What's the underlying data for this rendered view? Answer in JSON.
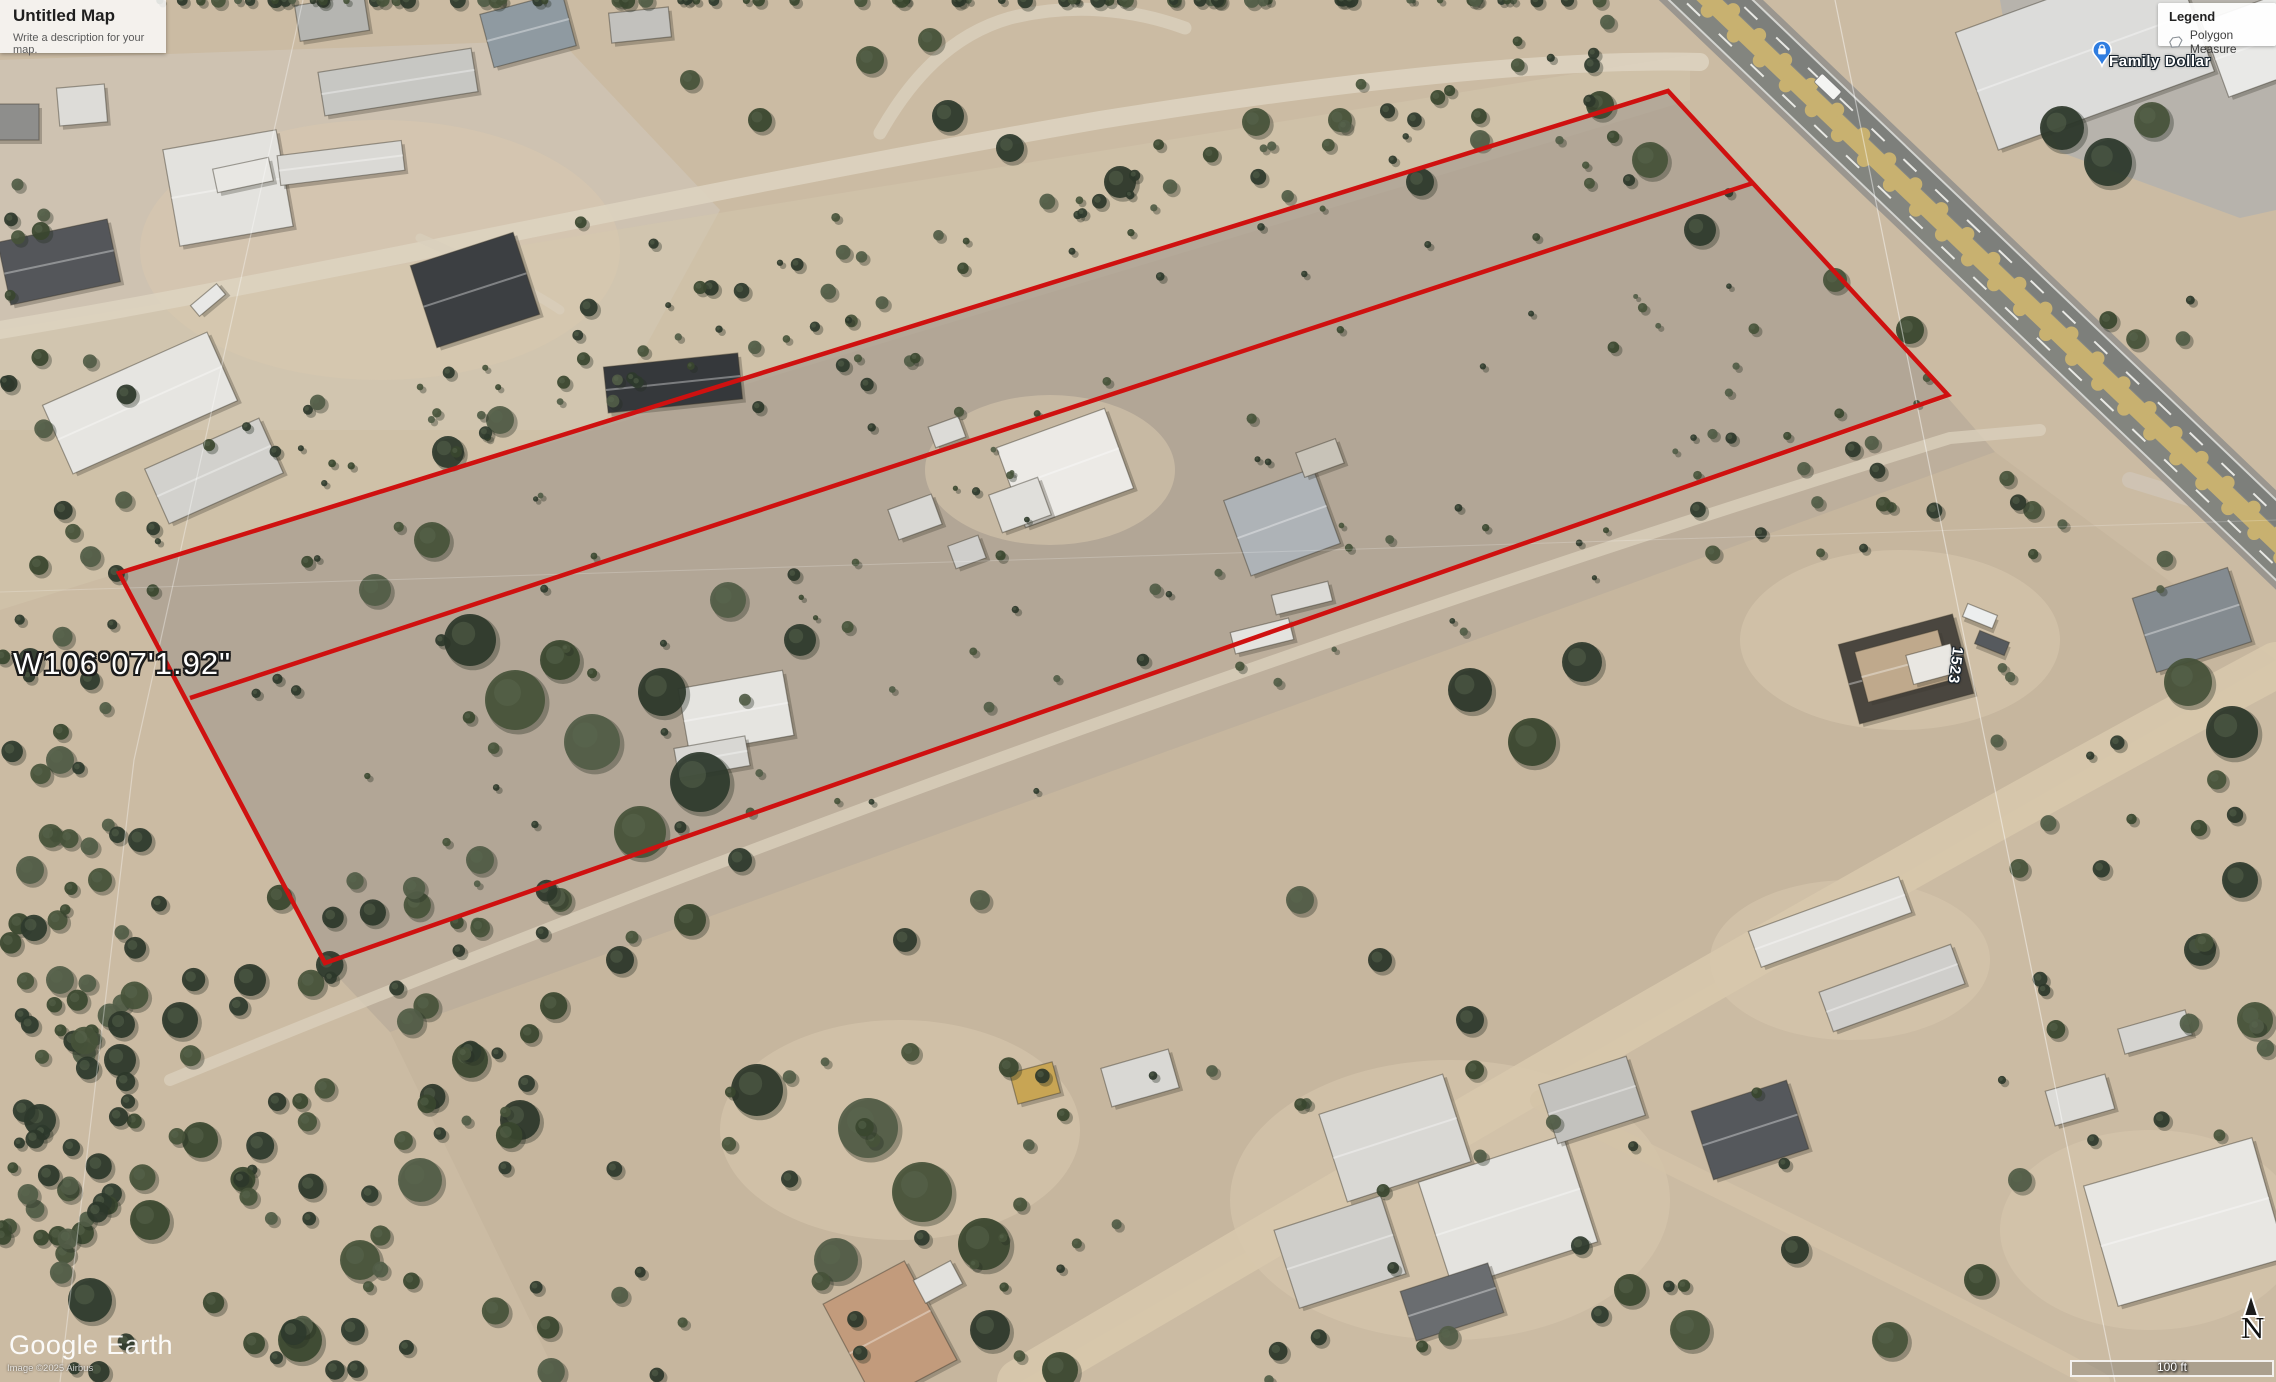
{
  "map_panel": {
    "title": "Untitled Map",
    "description_placeholder": "Write a description for your map."
  },
  "legend_panel": {
    "title": "Legend",
    "items": [
      {
        "icon": "polygon-icon",
        "label": "Polygon Measure"
      }
    ]
  },
  "map_labels": {
    "place": {
      "name": "Family Dollar",
      "icon": "place-pin-icon",
      "pin_color": "#2f7de0"
    },
    "coordinate": "W106°07'1.92\"",
    "house_number": "1523"
  },
  "watermark": {
    "logo": "Google Earth",
    "attribution": "Image ©2025 Airbus"
  },
  "navigation": {
    "north_label": "N",
    "scale_label": "100 ft"
  },
  "measure_overlay": {
    "color": "#cf1110",
    "stroke_width": 4.5,
    "outline_points": [
      [
        119,
        573
      ],
      [
        1668,
        91
      ],
      [
        1948,
        395
      ],
      [
        325,
        963
      ]
    ],
    "divider_line": [
      [
        190,
        698
      ],
      [
        1753,
        183
      ]
    ]
  }
}
